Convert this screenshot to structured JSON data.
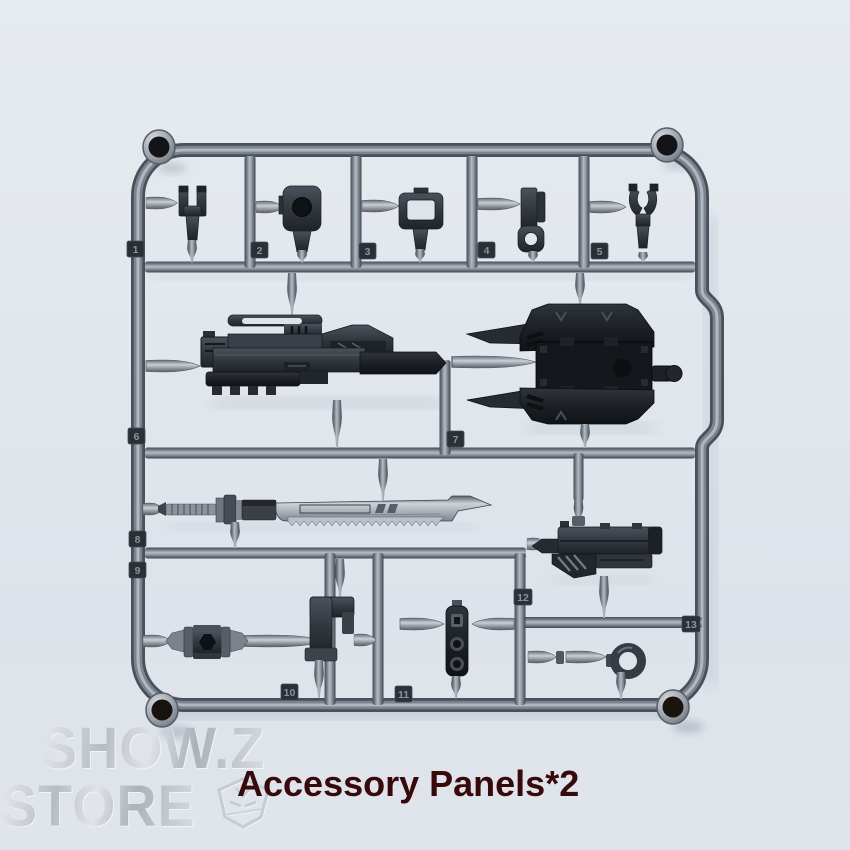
{
  "photo": {
    "background_top_color": "#e6ebf0",
    "background_bottom_color": "#dde3ea",
    "sprue_plastic_color": "#79828c",
    "dark_part_color": "#272c31",
    "blade_color": "#b3bac2"
  },
  "sprue": {
    "tags": [
      "1",
      "2",
      "3",
      "4",
      "5",
      "6",
      "7",
      "8",
      "9",
      "10",
      "11",
      "12",
      "13"
    ]
  },
  "watermark": {
    "line1": "SHOW.Z",
    "line2": "STORE"
  },
  "caption": {
    "text": "Accessory Panels*2",
    "color": "#37090b"
  }
}
